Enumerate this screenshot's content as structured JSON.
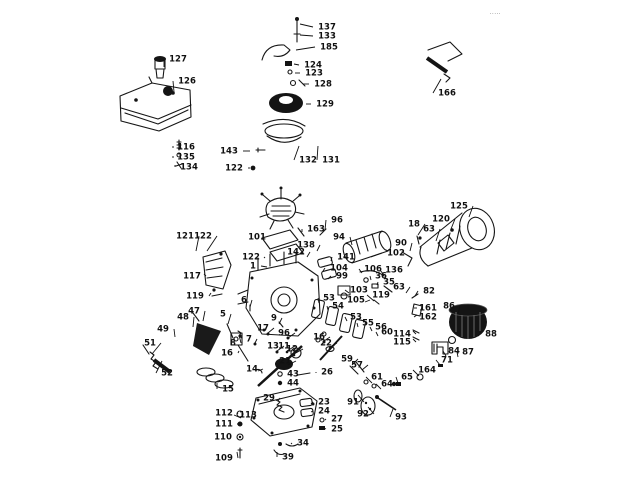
{
  "page": {
    "background": "#ffffff",
    "ink": "#161616"
  },
  "diagram": {
    "kind": "engine-exploded-parts-diagram",
    "corner_mark": "·····",
    "labels": [
      {
        "n": "127",
        "x": 178,
        "y": 59,
        "lx": 164,
        "ly": 67
      },
      {
        "n": "126",
        "x": 187,
        "y": 81,
        "lx": 174,
        "ly": 92
      },
      {
        "n": "116",
        "x": 186,
        "y": 147,
        "lx": 174,
        "ly": 147
      },
      {
        "n": "135",
        "x": 186,
        "y": 157,
        "lx": 174,
        "ly": 157
      },
      {
        "n": "134",
        "x": 189,
        "y": 167,
        "lx": 175,
        "ly": 165
      },
      {
        "n": "137",
        "x": 327,
        "y": 27,
        "lx": 300,
        "ly": 24
      },
      {
        "n": "133",
        "x": 327,
        "y": 36,
        "lx": 300,
        "ly": 35
      },
      {
        "n": "185",
        "x": 329,
        "y": 47,
        "lx": 296,
        "ly": 50
      },
      {
        "n": "124",
        "x": 313,
        "y": 65,
        "lx": 294,
        "ly": 64
      },
      {
        "n": "123",
        "x": 314,
        "y": 73,
        "lx": 295,
        "ly": 73
      },
      {
        "n": "128",
        "x": 323,
        "y": 84,
        "lx": 303,
        "ly": 84
      },
      {
        "n": "129",
        "x": 325,
        "y": 104,
        "lx": 306,
        "ly": 104
      },
      {
        "n": "143",
        "x": 229,
        "y": 151,
        "lx": 250,
        "ly": 151
      },
      {
        "n": "122",
        "x": 234,
        "y": 168,
        "lx": 250,
        "ly": 168
      },
      {
        "n": "132",
        "x": 308,
        "y": 160,
        "lx": 299,
        "ly": 146
      },
      {
        "n": "131",
        "x": 331,
        "y": 160,
        "lx": 318,
        "ly": 146
      },
      {
        "n": "166",
        "x": 447,
        "y": 93,
        "lx": 441,
        "ly": 79
      },
      {
        "n": "96",
        "x": 337,
        "y": 220,
        "lx": 325,
        "ly": 230
      },
      {
        "n": "163",
        "x": 316,
        "y": 229,
        "lx": 302,
        "ly": 232
      },
      {
        "n": "94",
        "x": 339,
        "y": 237,
        "lx": 352,
        "ly": 245
      },
      {
        "n": "101",
        "x": 257,
        "y": 237,
        "lx": 271,
        "ly": 237
      },
      {
        "n": "138",
        "x": 306,
        "y": 245,
        "lx": 317,
        "ly": 251
      },
      {
        "n": "142",
        "x": 296,
        "y": 252,
        "lx": 307,
        "ly": 257
      },
      {
        "n": "122",
        "x": 251,
        "y": 257,
        "lx": 264,
        "ly": 258
      },
      {
        "n": "1",
        "x": 253,
        "y": 266,
        "lx": 267,
        "ly": 267
      },
      {
        "n": "141",
        "x": 346,
        "y": 257,
        "lx": 331,
        "ly": 261
      },
      {
        "n": "104",
        "x": 339,
        "y": 268,
        "lx": 323,
        "ly": 271
      },
      {
        "n": "99",
        "x": 342,
        "y": 276,
        "lx": 328,
        "ly": 279
      },
      {
        "n": "125",
        "x": 459,
        "y": 206,
        "lx": 469,
        "ly": 217
      },
      {
        "n": "120",
        "x": 441,
        "y": 219,
        "lx": 451,
        "ly": 229
      },
      {
        "n": "18",
        "x": 414,
        "y": 224,
        "lx": 418,
        "ly": 235
      },
      {
        "n": "63",
        "x": 429,
        "y": 229,
        "lx": 436,
        "ly": 241
      },
      {
        "n": "90",
        "x": 401,
        "y": 243,
        "lx": 410,
        "ly": 251
      },
      {
        "n": "102",
        "x": 396,
        "y": 253,
        "lx": 371,
        "ly": 257
      },
      {
        "n": "106",
        "x": 373,
        "y": 269,
        "lx": 362,
        "ly": 273
      },
      {
        "n": "136",
        "x": 394,
        "y": 270,
        "lx": 384,
        "ly": 275
      },
      {
        "n": "36",
        "x": 381,
        "y": 276,
        "lx": 371,
        "ly": 280
      },
      {
        "n": "35",
        "x": 389,
        "y": 282,
        "lx": 377,
        "ly": 285
      },
      {
        "n": "103",
        "x": 359,
        "y": 290,
        "lx": 349,
        "ly": 293
      },
      {
        "n": "105",
        "x": 356,
        "y": 300,
        "lx": 365,
        "ly": 302
      },
      {
        "n": "119",
        "x": 381,
        "y": 295,
        "lx": 374,
        "ly": 301
      },
      {
        "n": "82",
        "x": 429,
        "y": 291,
        "lx": 415,
        "ly": 296
      },
      {
        "n": "63",
        "x": 399,
        "y": 287,
        "lx": 406,
        "ly": 293
      },
      {
        "n": "161",
        "x": 428,
        "y": 308,
        "lx": 417,
        "ly": 308
      },
      {
        "n": "162",
        "x": 428,
        "y": 317,
        "lx": 417,
        "ly": 315
      },
      {
        "n": "114",
        "x": 402,
        "y": 334,
        "lx": 413,
        "ly": 331
      },
      {
        "n": "115",
        "x": 402,
        "y": 342,
        "lx": 413,
        "ly": 339
      },
      {
        "n": "121",
        "x": 185,
        "y": 236,
        "lx": 196,
        "ly": 251
      },
      {
        "n": "122",
        "x": 203,
        "y": 236,
        "lx": 207,
        "ly": 251
      },
      {
        "n": "117",
        "x": 192,
        "y": 276,
        "lx": 204,
        "ly": 274
      },
      {
        "n": "119",
        "x": 195,
        "y": 296,
        "lx": 211,
        "ly": 293
      },
      {
        "n": "47",
        "x": 194,
        "y": 311,
        "lx": 203,
        "ly": 321
      },
      {
        "n": "48",
        "x": 183,
        "y": 317,
        "lx": 193,
        "ly": 327
      },
      {
        "n": "49",
        "x": 163,
        "y": 329,
        "lx": 175,
        "ly": 337
      },
      {
        "n": "51",
        "x": 150,
        "y": 343,
        "lx": 152,
        "ly": 354
      },
      {
        "n": "52",
        "x": 167,
        "y": 373,
        "lx": 162,
        "ly": 361
      },
      {
        "n": "5",
        "x": 223,
        "y": 314,
        "lx": 228,
        "ly": 324
      },
      {
        "n": "8",
        "x": 233,
        "y": 343,
        "lx": 239,
        "ly": 335
      },
      {
        "n": "16",
        "x": 227,
        "y": 353,
        "lx": 239,
        "ly": 351
      },
      {
        "n": "15",
        "x": 228,
        "y": 389,
        "lx": 217,
        "ly": 383
      },
      {
        "n": "6",
        "x": 244,
        "y": 300,
        "lx": 250,
        "ly": 307
      },
      {
        "n": "9",
        "x": 274,
        "y": 318,
        "lx": 279,
        "ly": 324
      },
      {
        "n": "17",
        "x": 263,
        "y": 328,
        "lx": 268,
        "ly": 333
      },
      {
        "n": "96",
        "x": 284,
        "y": 333,
        "lx": 288,
        "ly": 338
      },
      {
        "n": "7",
        "x": 249,
        "y": 339,
        "lx": 255,
        "ly": 343
      },
      {
        "n": "13",
        "x": 273,
        "y": 346,
        "lx": 277,
        "ly": 351
      },
      {
        "n": "11",
        "x": 284,
        "y": 346,
        "lx": 287,
        "ly": 351
      },
      {
        "n": "12",
        "x": 292,
        "y": 349,
        "lx": 294,
        "ly": 354
      },
      {
        "n": "21",
        "x": 285,
        "y": 361,
        "lx": 288,
        "ly": 365
      },
      {
        "n": "16",
        "x": 319,
        "y": 337,
        "lx": 324,
        "ly": 341
      },
      {
        "n": "22",
        "x": 326,
        "y": 343,
        "lx": 330,
        "ly": 347
      },
      {
        "n": "14",
        "x": 252,
        "y": 369,
        "lx": 258,
        "ly": 371
      },
      {
        "n": "43",
        "x": 293,
        "y": 374,
        "lx": 282,
        "ly": 374
      },
      {
        "n": "44",
        "x": 293,
        "y": 383,
        "lx": 282,
        "ly": 383
      },
      {
        "n": "53",
        "x": 329,
        "y": 298,
        "lx": 319,
        "ly": 303
      },
      {
        "n": "54",
        "x": 338,
        "y": 306,
        "lx": 328,
        "ly": 310
      },
      {
        "n": "53",
        "x": 356,
        "y": 317,
        "lx": 347,
        "ly": 321
      },
      {
        "n": "55",
        "x": 368,
        "y": 323,
        "lx": 358,
        "ly": 327
      },
      {
        "n": "56",
        "x": 381,
        "y": 327,
        "lx": 372,
        "ly": 331
      },
      {
        "n": "60",
        "x": 387,
        "y": 332,
        "lx": 378,
        "ly": 336
      },
      {
        "n": "59",
        "x": 347,
        "y": 359,
        "lx": 352,
        "ly": 365
      },
      {
        "n": "57",
        "x": 357,
        "y": 365,
        "lx": 362,
        "ly": 370
      },
      {
        "n": "26",
        "x": 327,
        "y": 372,
        "lx": 316,
        "ly": 373
      },
      {
        "n": "61",
        "x": 377,
        "y": 377,
        "lx": 372,
        "ly": 383
      },
      {
        "n": "64",
        "x": 387,
        "y": 384,
        "lx": 381,
        "ly": 389
      },
      {
        "n": "65",
        "x": 407,
        "y": 377,
        "lx": 398,
        "ly": 383
      },
      {
        "n": "164",
        "x": 427,
        "y": 370,
        "lx": 419,
        "ly": 376
      },
      {
        "n": "91",
        "x": 353,
        "y": 402,
        "lx": 358,
        "ly": 395
      },
      {
        "n": "92",
        "x": 363,
        "y": 414,
        "lx": 368,
        "ly": 407
      },
      {
        "n": "93",
        "x": 401,
        "y": 417,
        "lx": 393,
        "ly": 409
      },
      {
        "n": "71",
        "x": 447,
        "y": 360,
        "lx": 440,
        "ly": 365
      },
      {
        "n": "84",
        "x": 454,
        "y": 351,
        "lx": 446,
        "ly": 356
      },
      {
        "n": "87",
        "x": 468,
        "y": 352,
        "lx": 458,
        "ly": 357
      },
      {
        "n": "86",
        "x": 449,
        "y": 306,
        "lx": 458,
        "ly": 314
      },
      {
        "n": "88",
        "x": 491,
        "y": 334,
        "lx": 478,
        "ly": 336
      },
      {
        "n": "29",
        "x": 269,
        "y": 398,
        "lx": 278,
        "ly": 401
      },
      {
        "n": "23",
        "x": 324,
        "y": 402,
        "lx": 311,
        "ly": 404
      },
      {
        "n": "24",
        "x": 324,
        "y": 411,
        "lx": 311,
        "ly": 412
      },
      {
        "n": "27",
        "x": 337,
        "y": 419,
        "lx": 325,
        "ly": 420
      },
      {
        "n": "25",
        "x": 337,
        "y": 429,
        "lx": 324,
        "ly": 428
      },
      {
        "n": "112",
        "x": 224,
        "y": 413,
        "lx": 237,
        "ly": 414
      },
      {
        "n": "113",
        "x": 248,
        "y": 415,
        "lx": 241,
        "ly": 418
      },
      {
        "n": "111",
        "x": 224,
        "y": 424,
        "lx": 237,
        "ly": 424
      },
      {
        "n": "110",
        "x": 223,
        "y": 437,
        "lx": 237,
        "ly": 437
      },
      {
        "n": "109",
        "x": 224,
        "y": 458,
        "lx": 237,
        "ly": 452
      },
      {
        "n": "34",
        "x": 303,
        "y": 443,
        "lx": 291,
        "ly": 444
      },
      {
        "n": "39",
        "x": 288,
        "y": 457,
        "lx": 277,
        "ly": 452
      }
    ]
  }
}
